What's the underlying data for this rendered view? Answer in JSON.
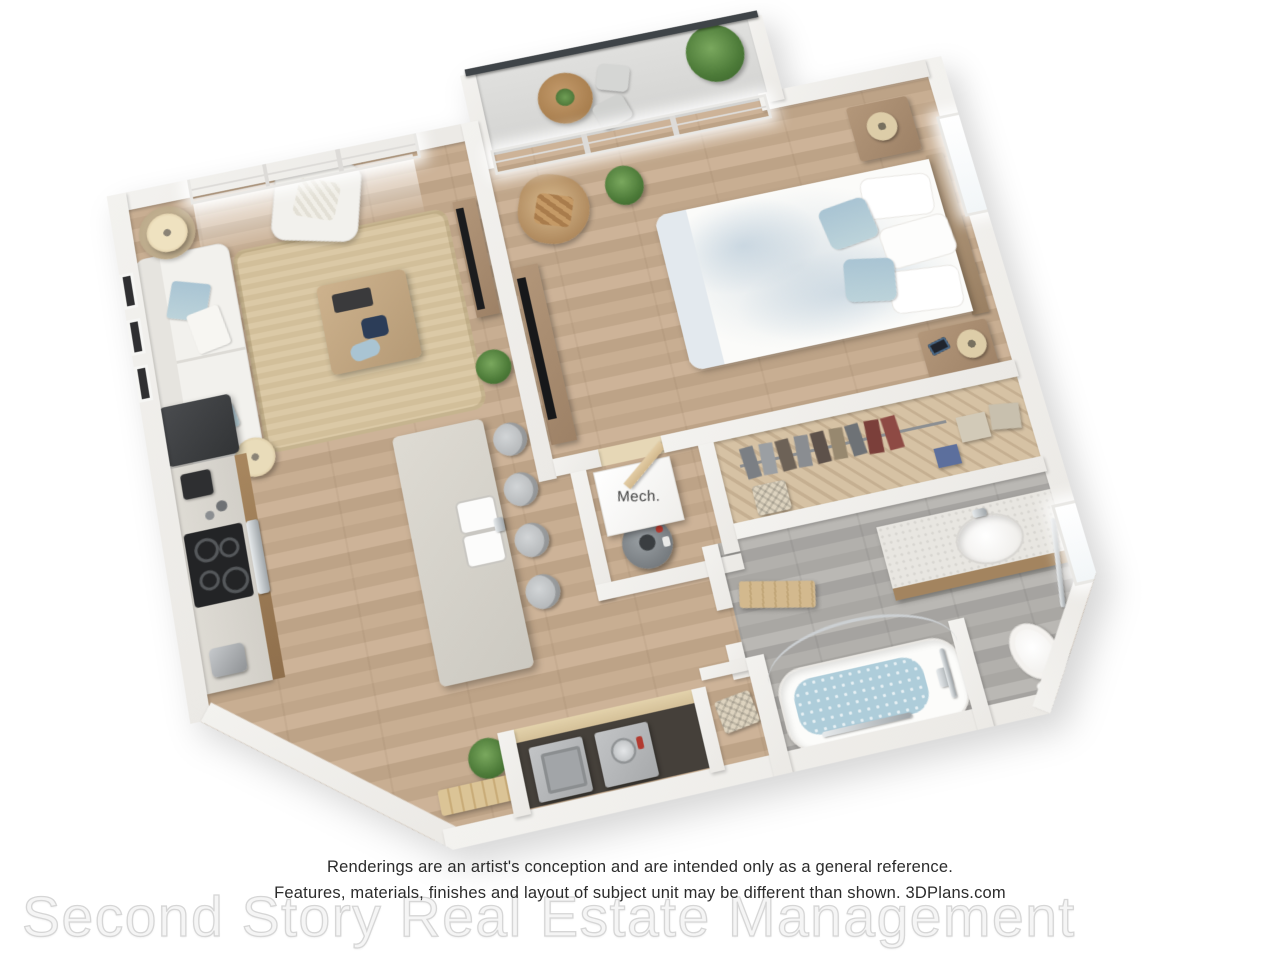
{
  "image": {
    "kind": "3d-floor-plan-rendering",
    "view": "top-down perspective, plan tilted counter-clockwise"
  },
  "labels": {
    "mech": "Mech."
  },
  "disclaimer": {
    "line1": "Renderings are an artist's conception and are intended only as a general reference.",
    "line2": "Features, materials, finishes and layout of subject unit may be different than shown. 3DPlans.com"
  },
  "watermark": {
    "text": "Second Story Real Estate Management"
  },
  "rooms": [
    "balcony",
    "living-room",
    "bedroom",
    "kitchen",
    "dining-island",
    "hallway",
    "mechanical-room",
    "closet",
    "bathroom",
    "laundry-closet"
  ],
  "furniture": {
    "balcony": [
      "railing",
      "bistro-table",
      "patio-chairs",
      "potted-plants"
    ],
    "living_room": [
      "window",
      "sofa",
      "blue-throw-pillows",
      "jute-area-rug",
      "coffee-table",
      "armchair",
      "floor-lamps",
      "wall-art-frames",
      "tv-console",
      "plant"
    ],
    "kitchen": [
      "refrigerator",
      "counter-cabinets",
      "cooktop-oven",
      "coffee-maker",
      "toaster",
      "island-with-double-sink",
      "bar-stools"
    ],
    "bedroom": [
      "sliding-glass-door",
      "bed-floral-duvet",
      "nightstands",
      "table-lamps",
      "media-console-tv",
      "wicker-chair",
      "plant",
      "window",
      "door"
    ],
    "mechanical_room": [
      "mech-unit-box",
      "water-heater"
    ],
    "closet": [
      "hanging-clothes",
      "storage-boxes",
      "blue-box",
      "hamper"
    ],
    "bathroom": [
      "vanity-sink",
      "bathtub-with-water",
      "curved-shower-rod",
      "grab-bars",
      "toilet",
      "window",
      "entry-bench",
      "basket-niche",
      "bath-mat"
    ],
    "laundry": [
      "counter",
      "washer",
      "dryer"
    ]
  },
  "palette": {
    "wall": "#f3f2ef",
    "wood": "#c8ae92",
    "graywood": "#aba9a5",
    "accent": "#a9c4d3",
    "rug": "#dbc9a6",
    "cabinet": "#9a7b5a",
    "counter": "#d9d6cf",
    "island": "#d8d5cd",
    "appliance": "#3f4144",
    "water": "#aecdda",
    "railing": "#3f4448",
    "green": "#5d8f4a",
    "text": "#2b2b2b",
    "watermark": "#dcdcdc"
  }
}
